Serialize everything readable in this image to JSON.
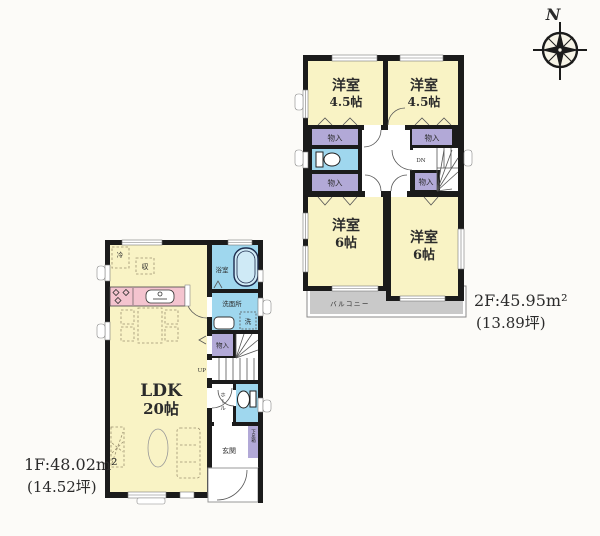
{
  "compass": {
    "north": "N"
  },
  "labels": {
    "western_room": "洋室",
    "size_4_5": "4.5帖",
    "size_6": "6帖",
    "closet": "物入",
    "balcony": "バルコニー",
    "down": "DN",
    "up": "UP",
    "ldk": "LDK",
    "ldk_size": "20帖",
    "bath": "浴室",
    "washroom": "洗面所",
    "washer": "洗",
    "hall": "ホール",
    "entrance": "玄関",
    "shoe_cabinet": "下足箱",
    "fridge": "冷",
    "storage": "収"
  },
  "floor1": {
    "area_line1": "1F:48.02m²",
    "area_line2": "(14.52坪)"
  },
  "floor2": {
    "area_line1": "2F:45.95m²",
    "area_line2": "(13.89坪)"
  },
  "colors": {
    "wall": "#1b1b1b",
    "room_yellow": "#f9f3c5",
    "water_blue": "#9fd7ee",
    "closet_purple": "#b2a9d7",
    "kitchen_pink": "#f4c4cf",
    "balcony_gray": "#c9c9c9"
  }
}
